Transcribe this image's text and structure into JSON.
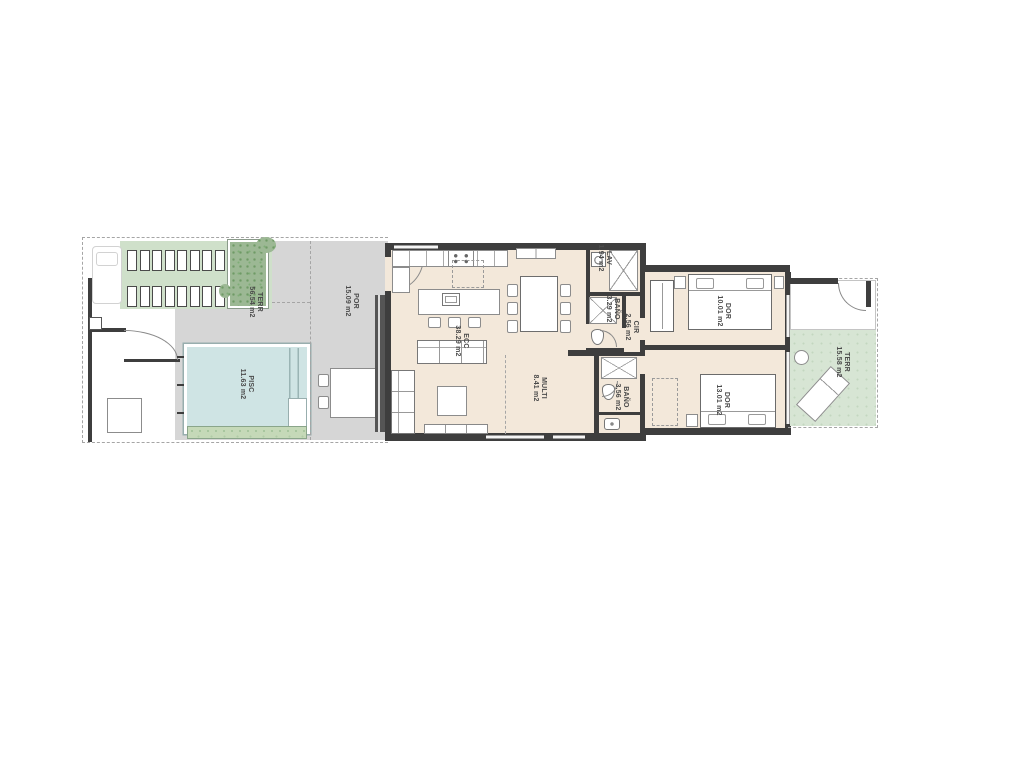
{
  "plan": {
    "type": "apartment-floor-plan",
    "units": "m2"
  },
  "palette": {
    "wall": "#3e3e3e",
    "interior_floor": "#f3e8da",
    "patio_gray": "#d6d6d6",
    "deck_green": "#cfe0ca",
    "terrace_green": "#d7e5d4",
    "pool_blue": "#cfe4e4"
  },
  "rooms": [
    {
      "id": "terrace-left",
      "name": "TERR",
      "area": "56.54 m2"
    },
    {
      "id": "porch",
      "name": "POR",
      "area": "15.09 m2"
    },
    {
      "id": "pool",
      "name": "PISC",
      "area": "11.63 m2"
    },
    {
      "id": "living-kitchen",
      "name": "ECC",
      "area": "38.29 m2"
    },
    {
      "id": "laundry",
      "name": "LAV",
      "area": "1.94 m2"
    },
    {
      "id": "bathroom-1",
      "name": "BAÑO",
      "area": "3.29 m2"
    },
    {
      "id": "circulation",
      "name": "CIR",
      "area": "2.56 m2"
    },
    {
      "id": "multi-room",
      "name": "MULTI",
      "area": "8.41 m2"
    },
    {
      "id": "bathroom-2",
      "name": "BAÑO",
      "area": "3.56 m2"
    },
    {
      "id": "bedroom-1",
      "name": "DOR",
      "area": "10.01 m2"
    },
    {
      "id": "bedroom-2",
      "name": "DOR",
      "area": "13.01 m2"
    },
    {
      "id": "terrace-right",
      "name": "TERR",
      "area": "15.58 m2"
    }
  ]
}
